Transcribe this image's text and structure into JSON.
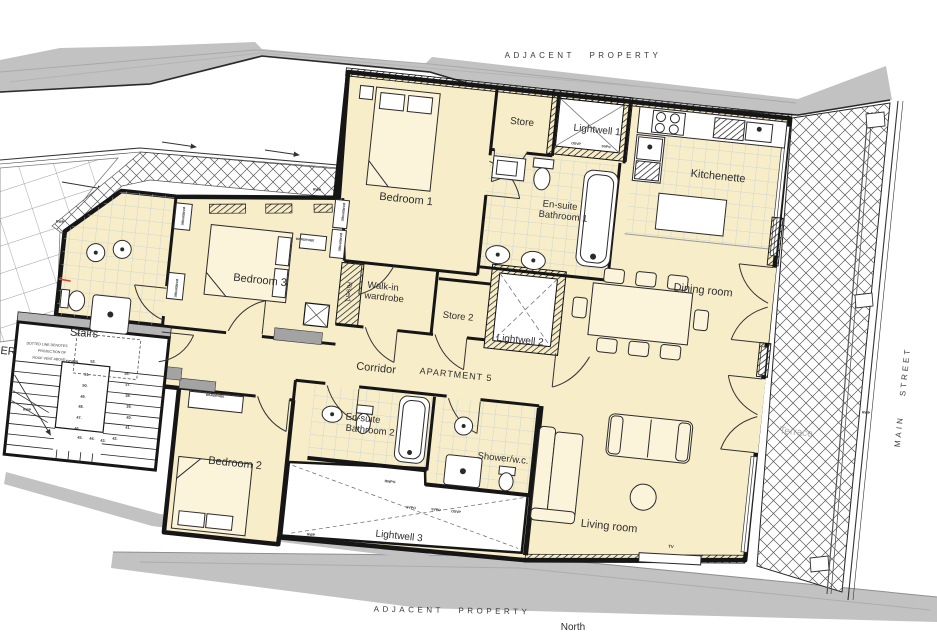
{
  "site": {
    "adjacent_property_top": "ADJACENT PROPERTY",
    "adjacent_property_bottom": "ADJACENT PROPERTY",
    "main_street": "MAIN STREET",
    "north_label": "North",
    "terrace": "Terrace",
    "partial_riser_label": "ER"
  },
  "unit": {
    "name": "APARTMENT 5",
    "rooms": {
      "bedroom1": "Bedroom 1",
      "bedroom2": "Bedroom 2",
      "bedroom3": "Bedroom 3",
      "store": "Store",
      "store2": "Store 2",
      "lightwell1": "Lightwell 1",
      "lightwell2": "Lightwell 2",
      "lightwell3": "Lightwell 3",
      "kitchenette": "Kitchenette",
      "dining": "Dining room",
      "living": "Living room",
      "corridor": "Corridor",
      "ensuite1_line1": "En-suite",
      "ensuite1_line2": "Bathroom 1",
      "ensuite2_line1": "En-suite",
      "ensuite2_line2": "Bathroom 2",
      "walkin_line1": "Walk-in",
      "walkin_line2": "wardrobe",
      "shower_wc": "Shower/w.c.",
      "riser": "Riser1"
    }
  },
  "stairs": {
    "title": "Stairs",
    "note_line1": "DOTTED LINE DENOTES",
    "note_line2": "PROJECTION OF",
    "note_line3": "ROOF VENT ABOVE",
    "down": "DOWN",
    "numbers": {
      "n52": "52.",
      "n51": "51.",
      "n50": "50.",
      "n49": "49.",
      "n48": "48.",
      "n47": "47.",
      "n46": "46.",
      "n45": "45.",
      "n44": "44.",
      "n43": "43.",
      "n42": "42.",
      "n41": "41.",
      "n40": "40.",
      "n39": "39.",
      "n38": "38.",
      "n37": "37.",
      "n36": "36."
    }
  },
  "small_labels": {
    "wardrobe": "WARDROBE",
    "tv": "TV",
    "rwp": "RWP",
    "osvp": "OSVP",
    "svp_o": "SVPo",
    "rwpo": "RWPO",
    "svpo": "SVPO"
  },
  "colors": {
    "room_fill": "#f7edc9",
    "wall": "#1a1a1a",
    "band_gray": "#c2c2c2",
    "tile_line": "#c4cdd6",
    "accent_red": "#e03a2f"
  }
}
